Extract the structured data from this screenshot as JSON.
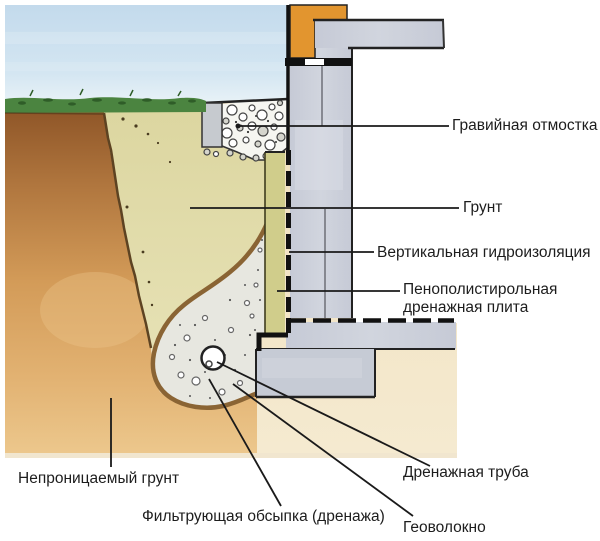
{
  "labels": {
    "gravel_blind_area": "Гравийная отмостка",
    "soil": "Грунт",
    "vertical_waterproofing": "Вертикальная гидроизоляция",
    "drainage_plate_line1": "Пенополистирольная",
    "drainage_plate_line2": "дренажная плита",
    "impermeable_soil": "Непроницаемый грунт",
    "filter_bedding": "Фильтрующая обсыпка (дренажа)",
    "drain_pipe": "Дренажная труба",
    "geotextile": "Геоволокно"
  },
  "colors": {
    "sky": "#cde1f0",
    "grass": "#4b8440",
    "topsoil_brown": "#8f5628",
    "subsoil_tan": "#e2b272",
    "backfill_khaki": "#ddd8a6",
    "concrete": "#c9cdd7",
    "brick_orange": "#e2952f",
    "drain_gravel": "#e6e6df",
    "geotextile_brown": "#8a6434",
    "plate_olive": "#d0cd8b",
    "under_floor_beige": "#f0e1bf",
    "leader_line": "#1a1a1a"
  }
}
